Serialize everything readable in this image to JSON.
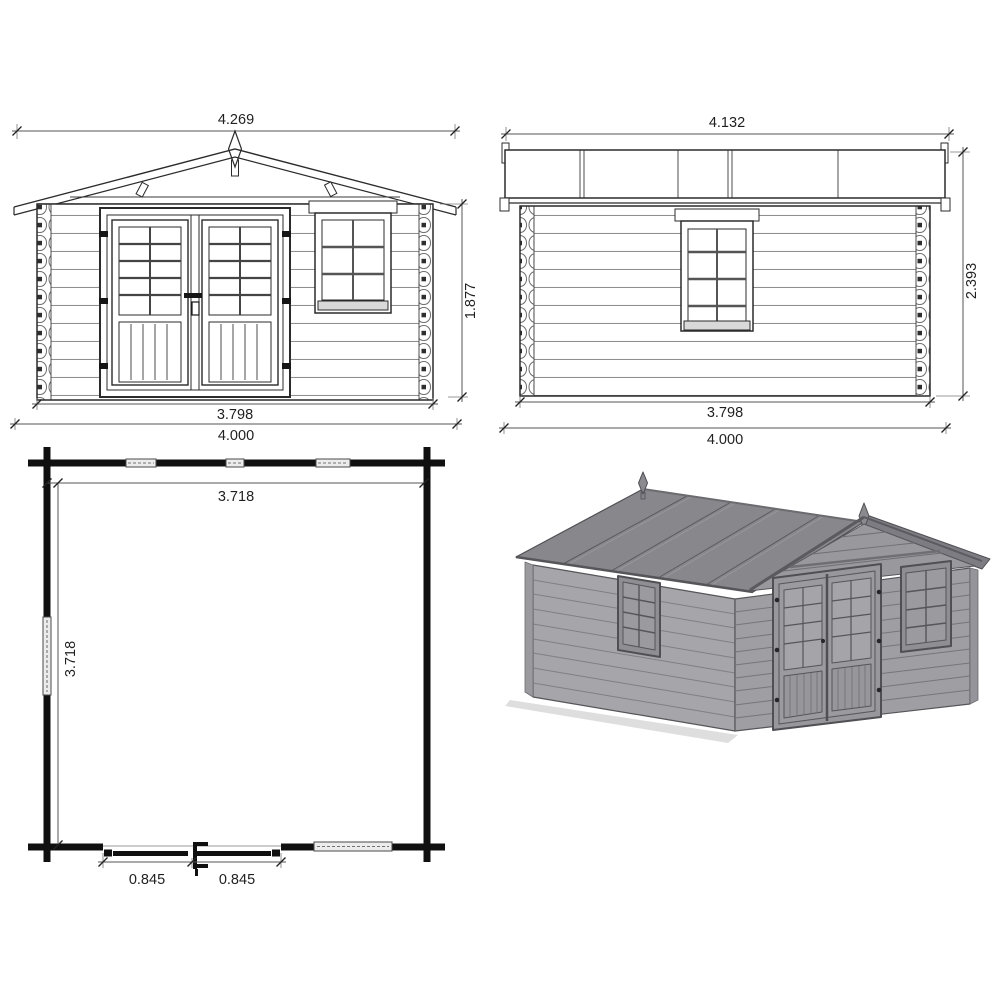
{
  "drawing": {
    "front": {
      "top_width": "4.269",
      "height": "1.877",
      "wall_width": "3.798",
      "overall_width": "4.000"
    },
    "side": {
      "top_width": "4.132",
      "height": "2.393",
      "wall_width": "3.798",
      "overall_width": "4.000"
    },
    "plan": {
      "inner_width": "3.718",
      "inner_depth": "3.718",
      "door_leaf_left": "0.845",
      "door_leaf_right": "0.845"
    },
    "colors": {
      "line": "#2b2b2b",
      "dim_text": "#1f1f1f",
      "roof_gray": "#87878c",
      "wall_gray": "#a6a6aa",
      "front_wall_gray": "#9e9ea3",
      "background": "#ffffff"
    }
  }
}
